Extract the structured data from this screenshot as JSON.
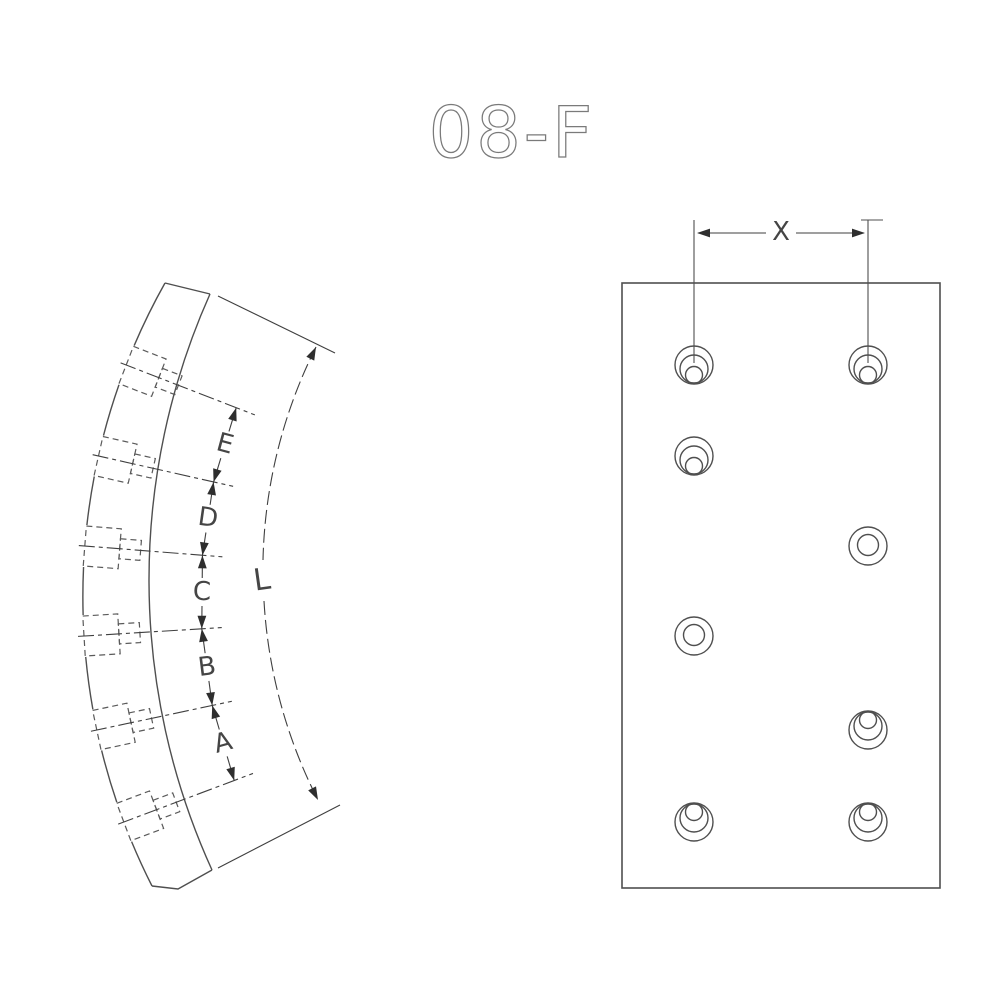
{
  "title": "08-F",
  "colors": {
    "line": "#4f4f4f",
    "hidden_line": "#5a5a5a",
    "dim_line": "#3f3f3f",
    "arrow": "#2e2e2e",
    "label": "#454545",
    "title": "#7a7a7a",
    "background": "#ffffff"
  },
  "side_view": {
    "description": "curved brake lining side profile with six hidden counterbored rivet holes",
    "dim_labels": [
      "E",
      "D",
      "C",
      "B",
      "A"
    ],
    "length_label": "L",
    "hole_rows_y": [
      365,
      456,
      546,
      636,
      730,
      822
    ]
  },
  "flat_view": {
    "description": "flat brake lining face with eight rivet holes",
    "dim_label": "X",
    "outline": {
      "x": 622,
      "y": 283,
      "width": 318,
      "height": 605
    },
    "hole_columns_x": [
      694,
      868
    ],
    "holes": [
      {
        "x": 694,
        "y": 365,
        "style": "cup-down"
      },
      {
        "x": 868,
        "y": 365,
        "style": "cup-down"
      },
      {
        "x": 694,
        "y": 456,
        "style": "cup-down"
      },
      {
        "x": 868,
        "y": 546,
        "style": "ring"
      },
      {
        "x": 694,
        "y": 636,
        "style": "ring"
      },
      {
        "x": 868,
        "y": 730,
        "style": "cup-up"
      },
      {
        "x": 694,
        "y": 822,
        "style": "cup-up"
      },
      {
        "x": 868,
        "y": 822,
        "style": "cup-up"
      }
    ]
  }
}
